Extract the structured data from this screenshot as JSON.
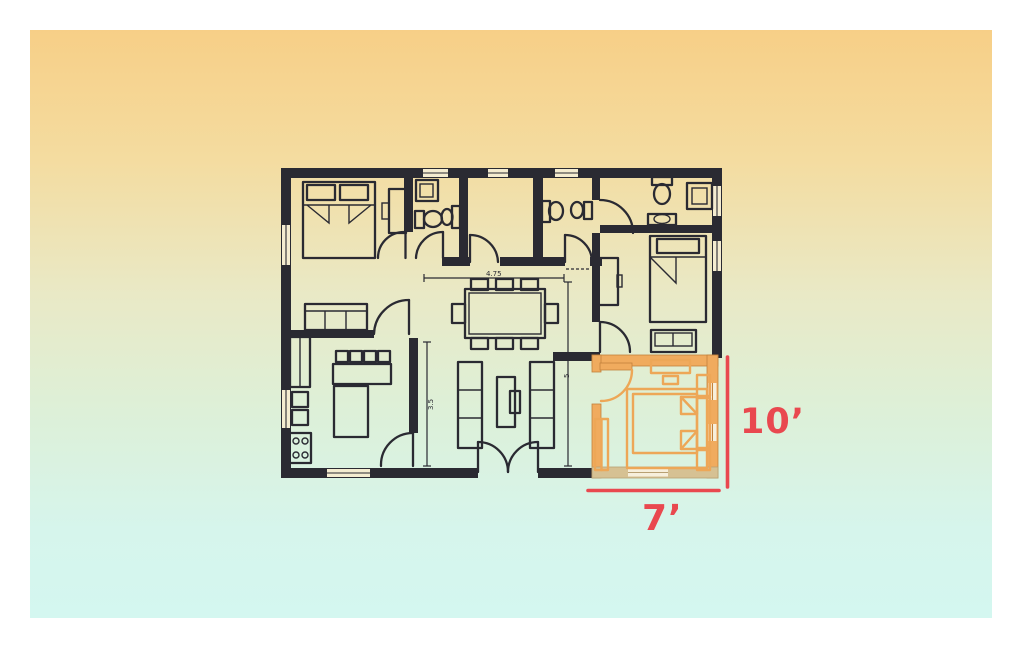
{
  "annotations": {
    "height_label": "10’",
    "width_label": "7’",
    "color": "#e9484f"
  },
  "plan_dimensions": {
    "hallway_width_label": "4.75",
    "center_height_label": "5",
    "kitchen_height_label": "3.5"
  },
  "colors": {
    "frame": "#ffffff",
    "background_top": "#f7cf87",
    "background_bottom": "#d4f7f0",
    "wall": "#2a2a32",
    "highlight_wall": "#f0ab5e",
    "highlight_bottom_wall": "#d6c193",
    "annotation_red": "#e9484f"
  }
}
